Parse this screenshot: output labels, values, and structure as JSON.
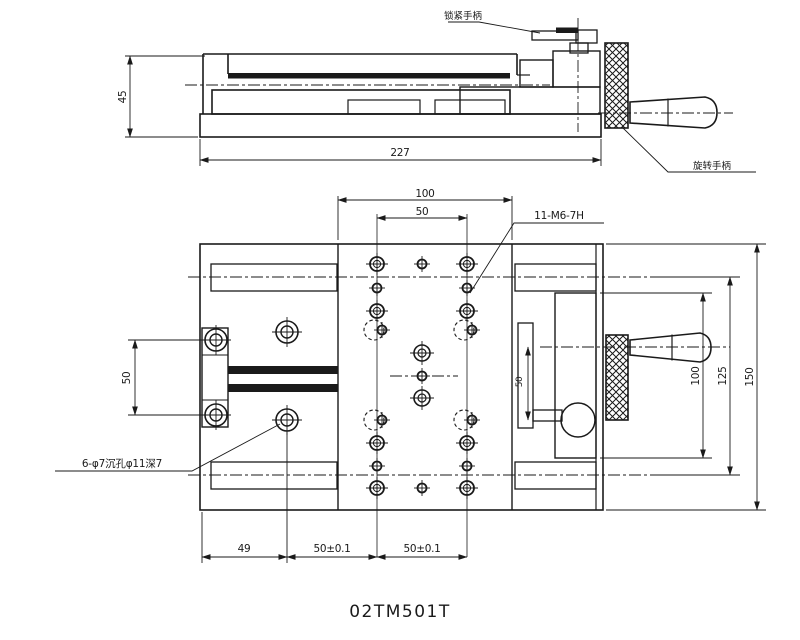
{
  "title": "02TM501T",
  "colors": {
    "line": "#1a1a1a",
    "background": "#ffffff"
  },
  "side_view": {
    "dim_height": "45",
    "dim_length": "227",
    "label_lock_handle": "锁紧手柄",
    "label_rotate_handle": "旋转手柄"
  },
  "plan_view": {
    "dim_top_outer": "100",
    "dim_top_inner": "50",
    "dim_left_pitch": "50",
    "dim_screw_offset": "50",
    "dim_right_inner": "100",
    "dim_right_mid": "125",
    "dim_right_outer": "150",
    "dim_bottom_1": "49",
    "dim_bottom_2": "50±0.1",
    "dim_bottom_3": "50±0.1",
    "callout_threads": "11-M6-7H",
    "callout_counterbore": "6-φ7沉孔φ11深7"
  }
}
